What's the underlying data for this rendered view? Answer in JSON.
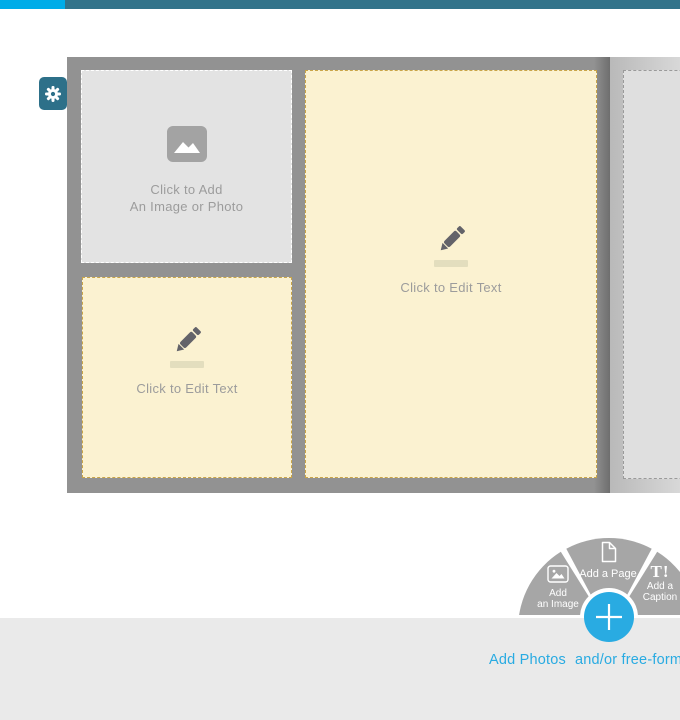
{
  "colors": {
    "topbar_cyan": "#00ace8",
    "topbar_teal": "#32738a",
    "gear_teal": "#2d7089",
    "canvas_gray": "#929292",
    "placeholder_gray": "#e3e3e3",
    "placeholder_cream": "#fbf2d1",
    "cream_dash_gold": "#c9a548",
    "band_gray": "#eaeaea",
    "fan_gray": "#a6a6a6",
    "accent_blue": "#29abe2"
  },
  "settings_button": {
    "icon": "gear-icon"
  },
  "page_editor": {
    "photo_slot": {
      "icon": "image-icon",
      "line1": "Click to Add",
      "line2": "An Image or Photo"
    },
    "text_slot_small": {
      "icon": "pencil-icon",
      "label": "Click to Edit Text"
    },
    "text_slot_large": {
      "icon": "pencil-icon",
      "label": "Click to Edit Text"
    },
    "next_page_slot": {}
  },
  "radial_menu": {
    "add_image": {
      "icon": "image-icon",
      "line1": "Add",
      "line2": "an Image"
    },
    "add_page": {
      "icon": "page-icon",
      "label": "Add a Page"
    },
    "add_caption": {
      "icon_text": "T!",
      "line1": "Add a",
      "line2": "Caption"
    },
    "plus": "+"
  },
  "footer": {
    "add_photos": "Add Photos",
    "tail": "and/or free-form text"
  }
}
